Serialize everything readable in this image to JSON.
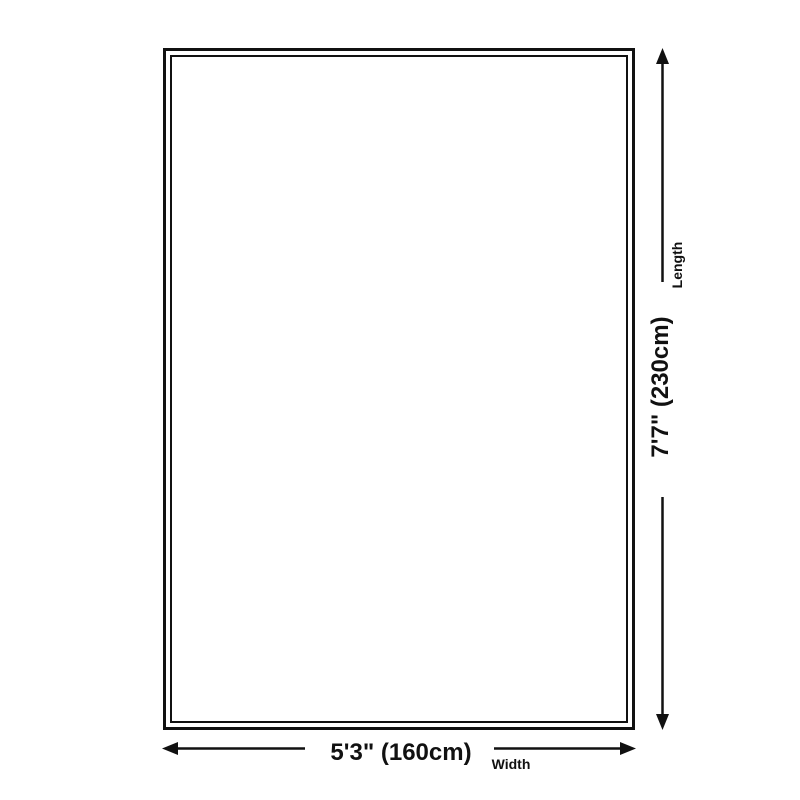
{
  "diagram": {
    "length_dimension": {
      "value": "7'7\" (230cm)",
      "label": "Length",
      "arrow_direction": "vertical"
    },
    "width_dimension": {
      "value": "5'3\" (160cm)",
      "label": "Width",
      "arrow_direction": "horizontal"
    },
    "colors": {
      "line": "#111111",
      "background": "#ffffff"
    }
  }
}
